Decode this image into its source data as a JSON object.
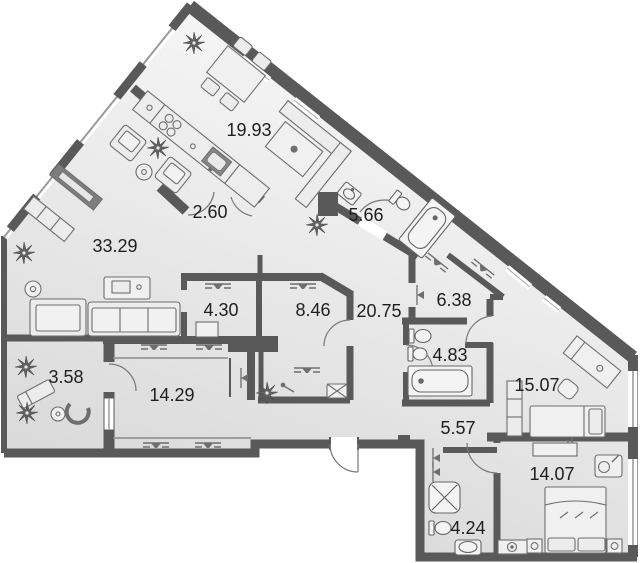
{
  "title": "apartment-floor-plan",
  "rooms": [
    {
      "name": "kitchen-dining",
      "area": "19.93"
    },
    {
      "name": "vestibule",
      "area": "2.60"
    },
    {
      "name": "bathroom-top",
      "area": "5.66"
    },
    {
      "name": "living-room",
      "area": "33.29"
    },
    {
      "name": "wardrobe-left",
      "area": "4.30"
    },
    {
      "name": "wardrobe-center",
      "area": "8.46"
    },
    {
      "name": "hallway",
      "area": "20.75"
    },
    {
      "name": "wardrobe-right",
      "area": "6.38"
    },
    {
      "name": "bathroom-middle",
      "area": "4.83"
    },
    {
      "name": "bedroom-right",
      "area": "15.07"
    },
    {
      "name": "balcony",
      "area": "3.58"
    },
    {
      "name": "bedroom-left",
      "area": "14.29"
    },
    {
      "name": "entry-hall",
      "area": "5.57"
    },
    {
      "name": "bedroom-bottom",
      "area": "14.07"
    },
    {
      "name": "bathroom-bottom",
      "area": "4.24"
    }
  ],
  "colors": {
    "wall": "#595959",
    "floor_light": "#f5f5f5",
    "floor_dark": "#d9d9d9",
    "furniture_stroke": "#6e6e6e",
    "fixture_fill": "#f4f4f4",
    "appliance_dark": "#868686",
    "label_text": "#1e1e1e",
    "outside": "#ffffff",
    "window_line": "#9b9b9b"
  },
  "symbols": {
    "plant": "plant-icon",
    "vent": "vent-grille-icon",
    "door_pivot": "door-pivot-icon",
    "door_arc": "door-swing-arc",
    "washer": "washing-machine-icon",
    "shower": "shower-cabin-icon",
    "bathtub": "bathtub-icon",
    "toilet": "toilet-icon",
    "sink": "sink-icon"
  }
}
